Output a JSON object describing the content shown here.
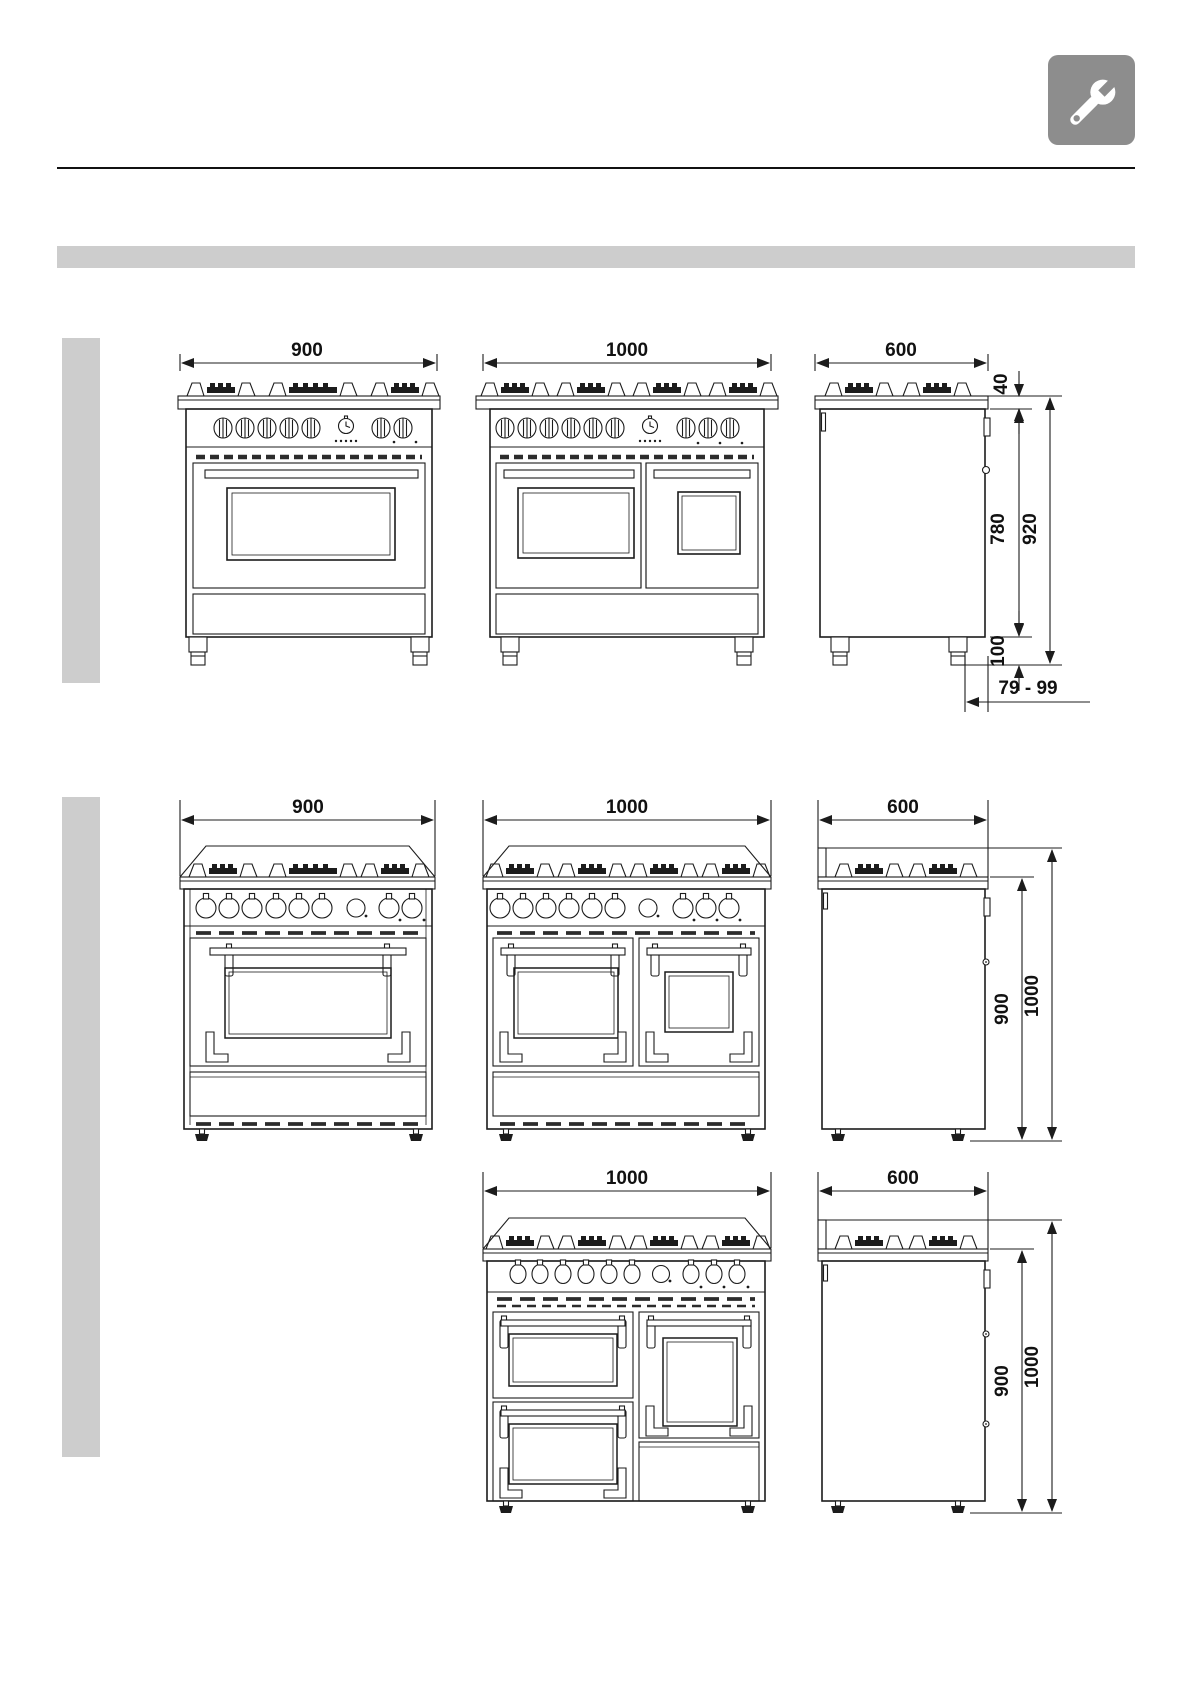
{
  "header": {
    "icon": "wrench",
    "icon_bg": "#8d8d8d"
  },
  "section_banner": {
    "color": "#cdcdcd"
  },
  "margin_bars": {
    "color": "#cdcdcd"
  },
  "line_color": "#1c1c1c",
  "groups": [
    {
      "title": "cooker-920mm-high-group",
      "front_900": "900",
      "front_1000": "1000",
      "side_600": "600",
      "dim_cooktop_height": "40",
      "dim_body_height": "780",
      "dim_total_height": "920",
      "dim_feet_height": "100",
      "dim_feet_range": "79 - 99"
    },
    {
      "title": "cooker-1000mm-high-group",
      "front_900": "900",
      "front_1000": "1000",
      "side_600": "600",
      "dim_worktop_height": "900",
      "dim_total_height": "1000"
    },
    {
      "title": "cooker-1000mm-high-triple-cavity-group",
      "front_1000": "1000",
      "side_600": "600",
      "dim_worktop_height": "900",
      "dim_total_height": "1000"
    }
  ]
}
